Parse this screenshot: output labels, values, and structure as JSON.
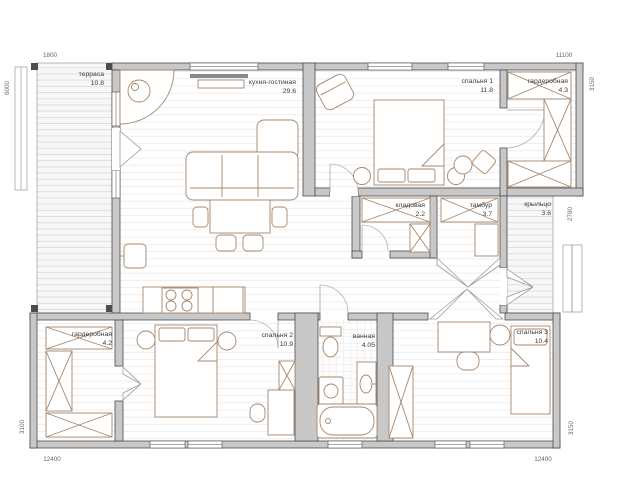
{
  "plan": {
    "rooms": [
      {
        "name": "терраса",
        "area": "10.8"
      },
      {
        "name": "кухня-гостиная",
        "area": "29.6"
      },
      {
        "name": "спальня 1",
        "area": "11.8"
      },
      {
        "name": "гардеробная",
        "area": "4.3"
      },
      {
        "name": "кладовая",
        "area": "2.2"
      },
      {
        "name": "тамбур",
        "area": "3.7"
      },
      {
        "name": "крыльцо",
        "area": "3.6"
      },
      {
        "name": "гардеробная",
        "area": "4.2"
      },
      {
        "name": "спальня 2",
        "area": "10.9"
      },
      {
        "name": "ванная",
        "area": "4.05"
      },
      {
        "name": "спальня 3",
        "area": "10.4"
      }
    ],
    "dimensions": {
      "top_left": "1800",
      "top_right": "11100",
      "left": "6000",
      "right_top": "3150",
      "right_mid": "2780",
      "right_bottom": "3150",
      "left_bottom": "3100",
      "bottom_left": "12400",
      "bottom_right": "12400"
    },
    "colors": {
      "wall": "#c8c8c8",
      "wall_outline": "#4d4d4d",
      "furniture": "#a5876c",
      "text": "#3a3a3a",
      "dim_text": "#666666"
    }
  }
}
